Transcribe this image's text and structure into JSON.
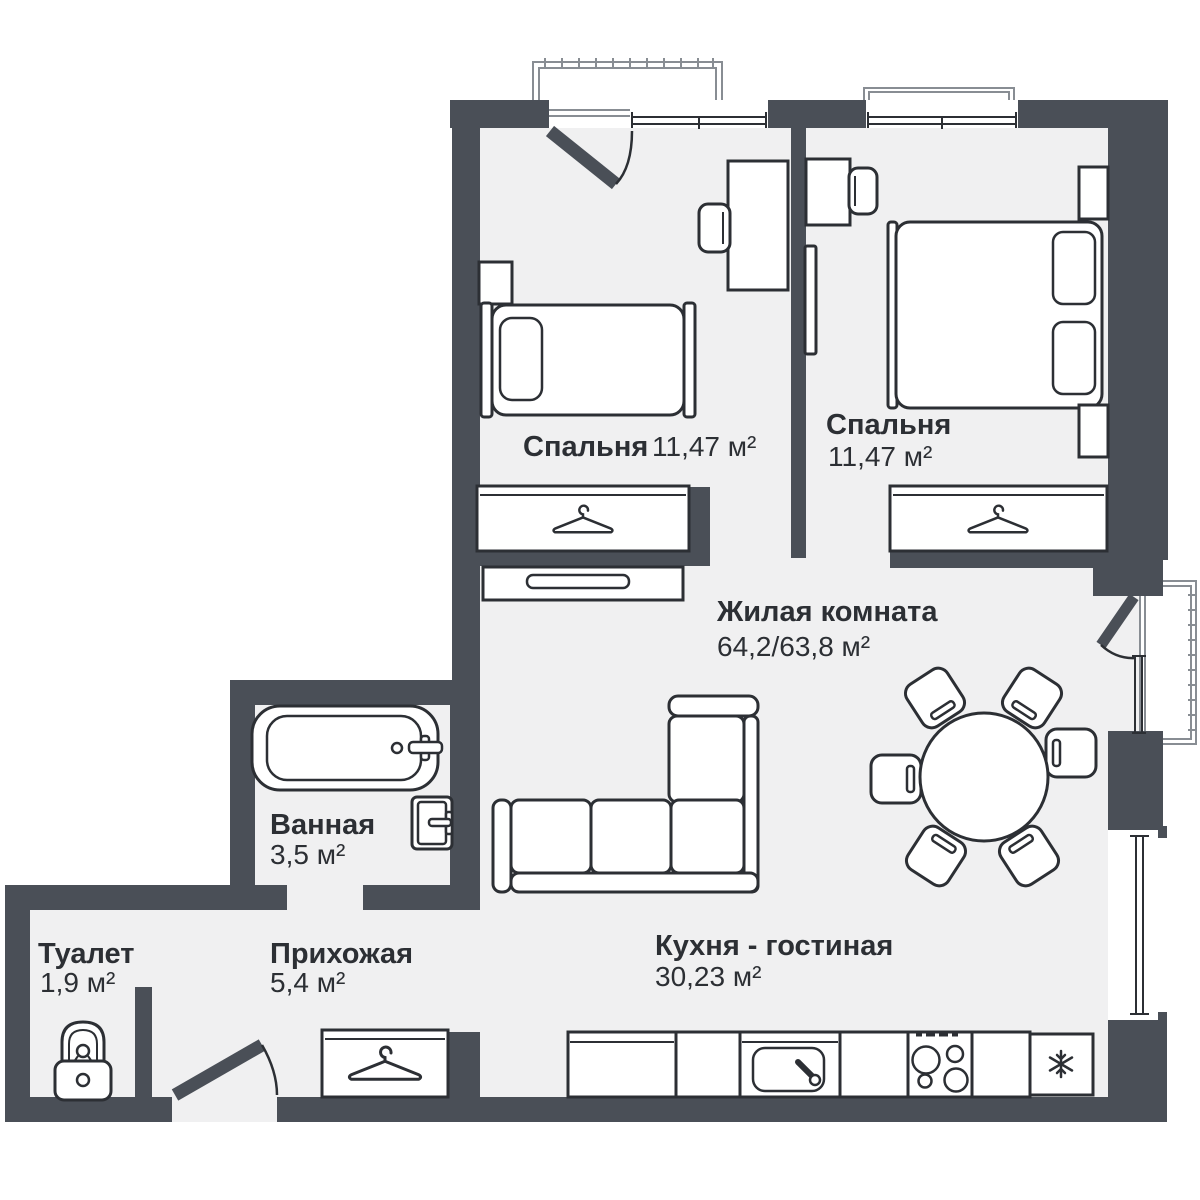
{
  "colors": {
    "wall": "#4a4f57",
    "floor": "#f0f0f1",
    "outline": "#2c2f34",
    "balcony_line": "#888d93",
    "text": "#2c2f34",
    "background": "#ffffff"
  },
  "rooms": [
    {
      "id": "bedroom-1",
      "name": "Спальня",
      "area": "11,47 м²",
      "furniture": [
        "single-bed",
        "pillow",
        "nightstand",
        "desk",
        "chair",
        "wardrobe-hanger",
        "tv-stand",
        "balcony-door"
      ]
    },
    {
      "id": "bedroom-2",
      "name": "Спальня",
      "area": "11,47 м²",
      "furniture": [
        "double-bed",
        "pillows",
        "nightstand",
        "nightstand",
        "desk",
        "chair",
        "wall-tv",
        "wardrobe-hanger",
        "window"
      ]
    },
    {
      "id": "living-room",
      "name": "Жилая комната",
      "area": "64,2/63,8 м²",
      "furniture": [
        "corner-sofa",
        "dining-table",
        "dining-chairs-x6",
        "balcony-door",
        "window"
      ]
    },
    {
      "id": "bathroom",
      "name": "Ванная",
      "area": "3,5 м²",
      "furniture": [
        "bathtub",
        "door"
      ]
    },
    {
      "id": "toilet",
      "name": "Туалет",
      "area": "1,9 м²",
      "furniture": [
        "wc-toilet"
      ]
    },
    {
      "id": "hallway",
      "name": "Прихожая",
      "area": "5,4 м²",
      "furniture": [
        "wardrobe-hanger",
        "entrance-door"
      ]
    },
    {
      "id": "kitchen-living",
      "name": "Кухня - гостиная",
      "area": "30,23 м²",
      "furniture": [
        "kitchen-counter",
        "sink",
        "stove-4-burners",
        "fridge-snowflake",
        "window"
      ]
    }
  ],
  "icons": {
    "hanger-icon": "clothes hanger glyph inside wardrobes",
    "snowflake-icon": "snowflake glyph inside fridge",
    "burner-icon": "stove burner circles",
    "wc-icon": "toilet bowl with cistern",
    "door-arc-icon": "quarter-circle door swing",
    "balcony-hatch-icon": "tick-hatched balcony railing"
  }
}
